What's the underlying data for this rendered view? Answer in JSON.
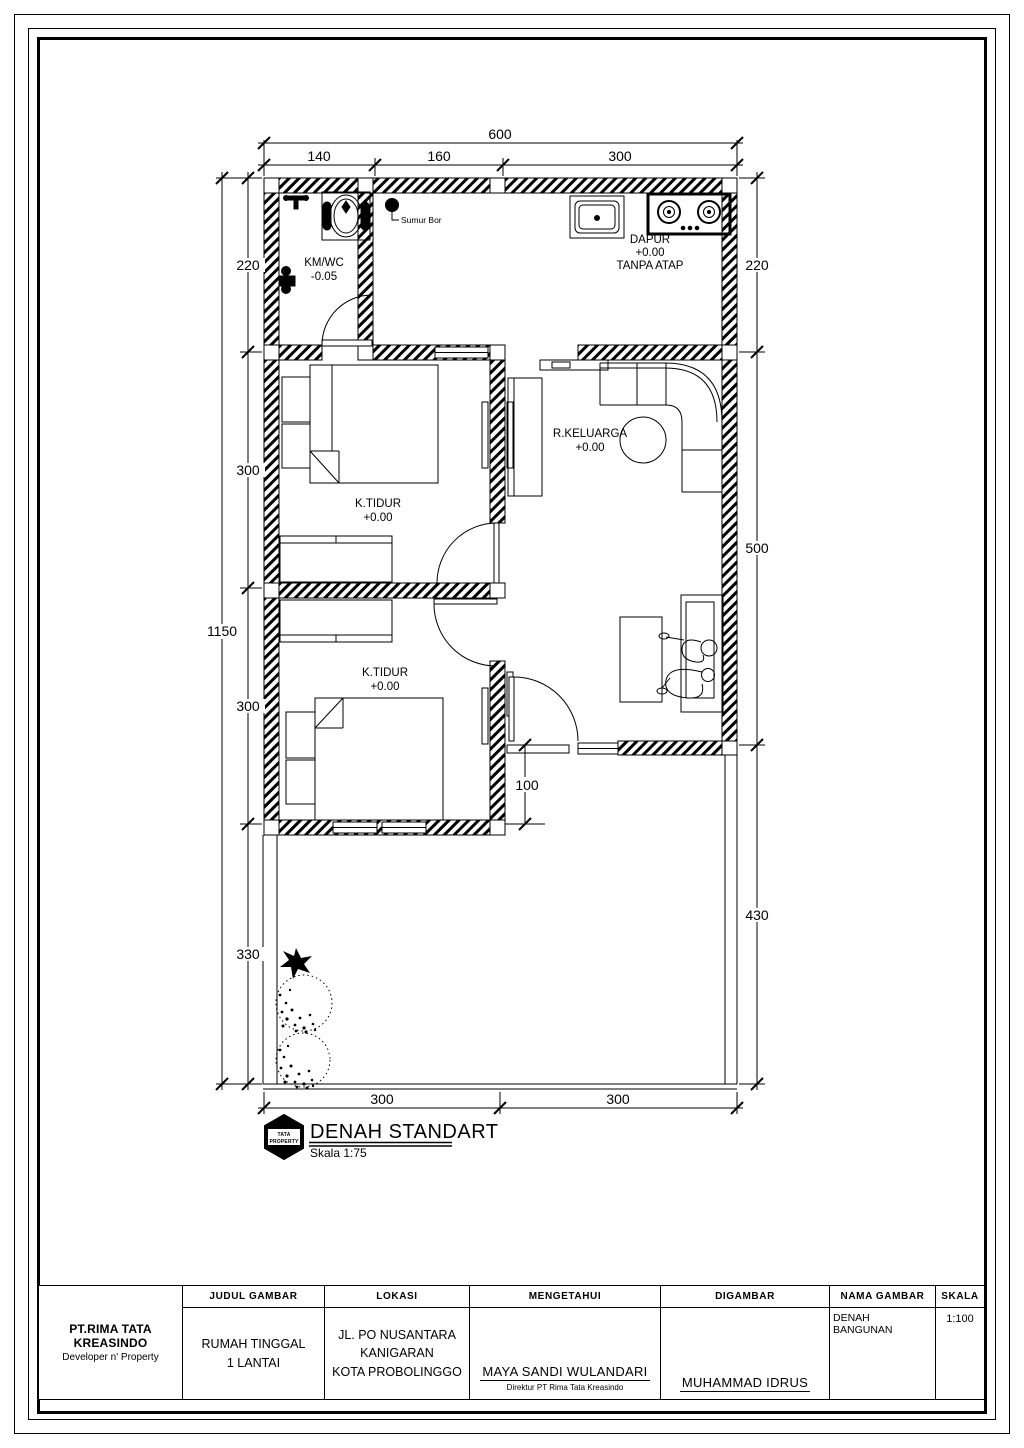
{
  "colors": {
    "ink": "#000000",
    "paper": "#ffffff"
  },
  "plan": {
    "title": "DENAH STANDART",
    "scale_label": "Skala 1:75",
    "logo_line1": "TATA",
    "logo_line2": "PROPERTY",
    "well_label": "Sumur Bor",
    "rooms": {
      "kmwc": {
        "name": "KM/WC",
        "level": "-0.05"
      },
      "dapur": {
        "name": "DAPUR",
        "level": "+0.00",
        "note": "TANPA ATAP"
      },
      "bedroom1": {
        "name": "K.TIDUR",
        "level": "+0.00"
      },
      "bedroom2": {
        "name": "K.TIDUR",
        "level": "+0.00"
      },
      "keluarga": {
        "name": "R.KELUARGA",
        "level": "+0.00"
      }
    },
    "dims": {
      "total_width": "600",
      "top": [
        "140",
        "160",
        "300"
      ],
      "left_total": "1150",
      "left": [
        "220",
        "300",
        "300",
        "330"
      ],
      "right": [
        "220",
        "500",
        "430"
      ],
      "bottom": [
        "300",
        "300"
      ],
      "porch": "100"
    }
  },
  "title_block": {
    "company_name": "PT.RIMA TATA KREASINDO",
    "company_tagline": "Developer n' Property",
    "judul_header": "JUDUL GAMBAR",
    "judul_line1": "RUMAH TINGGAL",
    "judul_line2": "1 LANTAI",
    "lokasi_header": "LOKASI",
    "lokasi_line1": "JL. PO NUSANTARA",
    "lokasi_line2": "KANIGARAN",
    "lokasi_line3": "KOTA PROBOLINGGO",
    "mengetahui_header": "MENGETAHUI",
    "mengetahui_name": "MAYA SANDI WULANDARI",
    "mengetahui_role": "Direktur PT Rima Tata Kreasindo",
    "digambar_header": "DIGAMBAR",
    "digambar_name": "MUHAMMAD IDRUS",
    "nama_header": "NAMA GAMBAR",
    "nama_value": "DENAH BANGUNAN",
    "skala_header": "SKALA",
    "skala_value": "1:100"
  }
}
